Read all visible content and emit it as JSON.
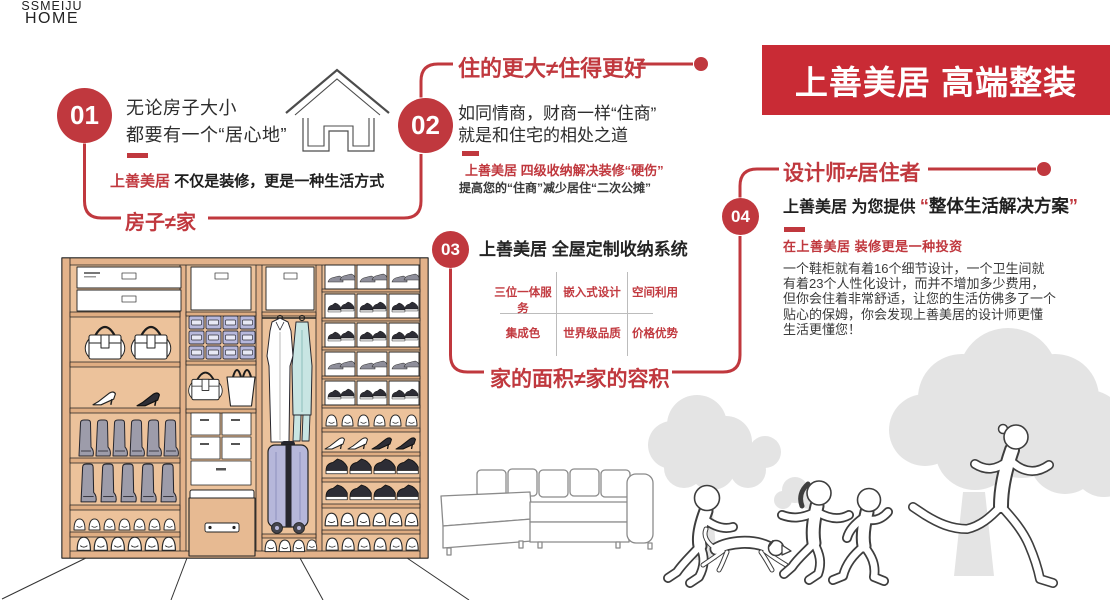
{
  "banner": {
    "title": "上善美居 高端整装"
  },
  "logo": {
    "line1": "SSMEIJU",
    "line2": "HOME"
  },
  "colors": {
    "accent_red": "#c0383e",
    "banner_red": "#c92b35",
    "text_dark": "#2b2b2b",
    "wood_tan": "#ecc29b",
    "tree_gray": "#e4e4e4",
    "bin_lavender": "#b7b8dc",
    "suitcase_lavender": "#b6b7da",
    "garment_teal": "#c8e5e3"
  },
  "sections": {
    "s1": {
      "num": "01",
      "line1": "无论房子大小",
      "line2": "都要有一个“居心地”",
      "brand": "上善美居",
      "tagline": "不仅是装修，更是一种生活方式",
      "keyword": "房子≠家"
    },
    "s2": {
      "num": "02",
      "title": "住的更大≠住得更好",
      "line1": "如同情商，财商一样“住商”",
      "line2": "就是和住宅的相处之道",
      "red_note": "上善美居 四级收纳解决装修“硬伤”",
      "gray_note": "提高您的“住商”减少居住“二次公摊”"
    },
    "s3": {
      "num": "03",
      "title": "上善美居 全屋定制收纳系统",
      "grid": {
        "row1": [
          "三位一体服务",
          "嵌入式设计",
          "空间利用"
        ],
        "row2": [
          "集成色",
          "世界级品质",
          "价格优势"
        ]
      },
      "keyword": "家的面积≠家的容积"
    },
    "s4": {
      "num": "04",
      "title": "设计师≠居住者",
      "sub_prefix": "上善美居 为您提供 ",
      "quote_open": "“",
      "sub_quoted": "整体生活解决方案",
      "quote_close": "”",
      "red_note": "在上善美居 装修更是一种投资",
      "body_lines": [
        "一个鞋柜就有着16个细节设计，一个卫生间就",
        "有着23个人性化设计，而并不增加多少费用，",
        "但你会住着非常舒适，让您的生活仿佛多了一个",
        "贴心的保姆，你会发现上善美居的设计师更懂",
        "生活更懂您！"
      ]
    }
  }
}
